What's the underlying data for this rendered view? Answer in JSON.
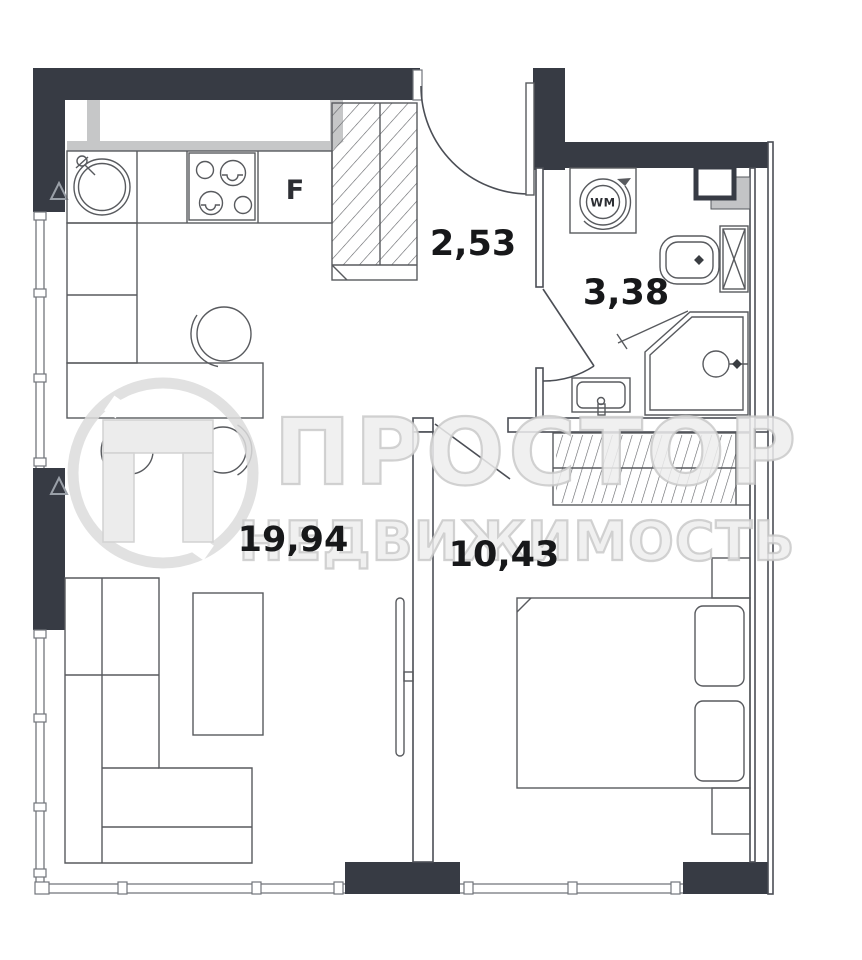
{
  "rooms": {
    "hallway_area": "2,53",
    "bathroom_area": "3,38",
    "living_kitchen_area": "19,94",
    "bedroom_area": "10,43"
  },
  "labels": {
    "fridge": "F",
    "washing_machine": "WM"
  },
  "watermark": {
    "brand_line1": "ПРОСТОР",
    "brand_line2": "НЕДВИЖИМОСТЬ"
  },
  "colors": {
    "wall": "#373b44",
    "line": "#4b4e55",
    "gray-band": "#c6c7c8",
    "watermark": "#ededed",
    "label": "#17181a"
  }
}
